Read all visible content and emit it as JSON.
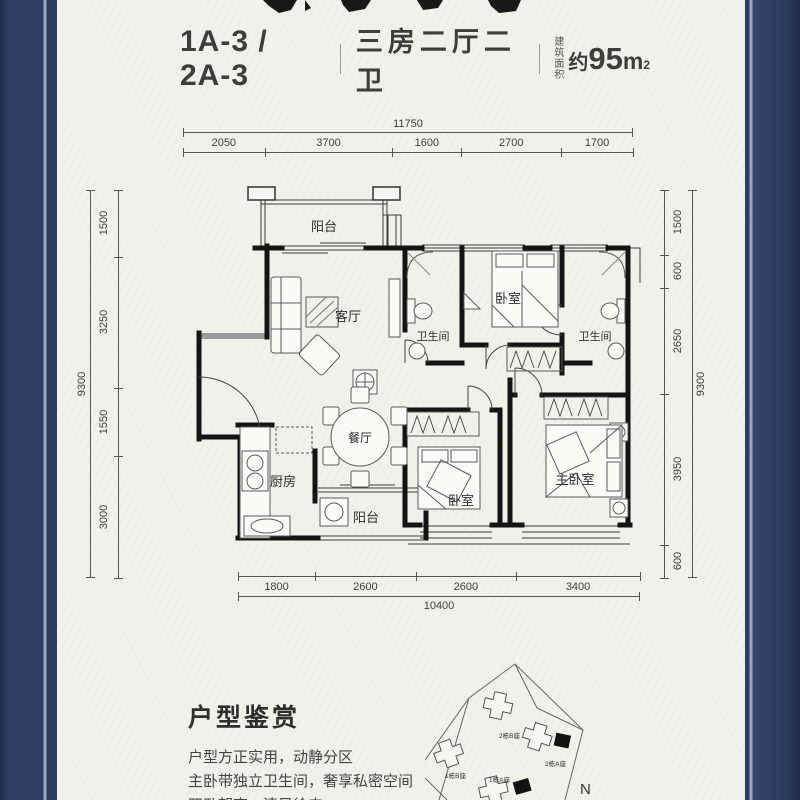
{
  "header": {
    "unit_code": "1A-3 / 2A-3",
    "layout_desc": "三房二厅二卫",
    "area_label_line1": "建筑",
    "area_label_line2": "面积",
    "area_approx": "约",
    "area_number": "95",
    "area_unit": "m",
    "area_sup": "2"
  },
  "dimensions": {
    "top": {
      "total": "11750",
      "segments": [
        "2050",
        "3700",
        "1600",
        "2700",
        "1700"
      ]
    },
    "bottom": {
      "total": "10400",
      "segments": [
        "1800",
        "2600",
        "2600",
        "3400"
      ]
    },
    "left": {
      "total": "9300",
      "segments": [
        "1500",
        "3250",
        "1550",
        "3000"
      ]
    },
    "right": {
      "total": "9300",
      "segments": [
        "1500",
        "600",
        "2650",
        "3950",
        "600"
      ]
    }
  },
  "plan": {
    "rooms": {
      "balcony_top": "阳台",
      "living": "客厅",
      "bath1": "卫生间",
      "bedroom_top": "卧室",
      "bath2": "卫生间",
      "dining": "餐厅",
      "kitchen": "厨房",
      "balcony_bottom": "阳台",
      "bedroom_second": "卧室",
      "master": "主卧室"
    }
  },
  "appreciation": {
    "heading": "户型鉴赏",
    "lines": [
      "户型方正实用，动静分区",
      "主卧带独立卫生间，奢享私密空间",
      "双卧朝南，清风徐来"
    ]
  },
  "site_map": {
    "buildings": [
      "2栋B座",
      "2栋A座",
      "1栋B座",
      "1栋A座"
    ],
    "compass": "N"
  },
  "colors": {
    "frame": "#2e3e62",
    "frame_stripe": "#9aa6bd",
    "background": "#f2f1ec",
    "wall_ink": "#141414",
    "dim_line": "#555555"
  }
}
